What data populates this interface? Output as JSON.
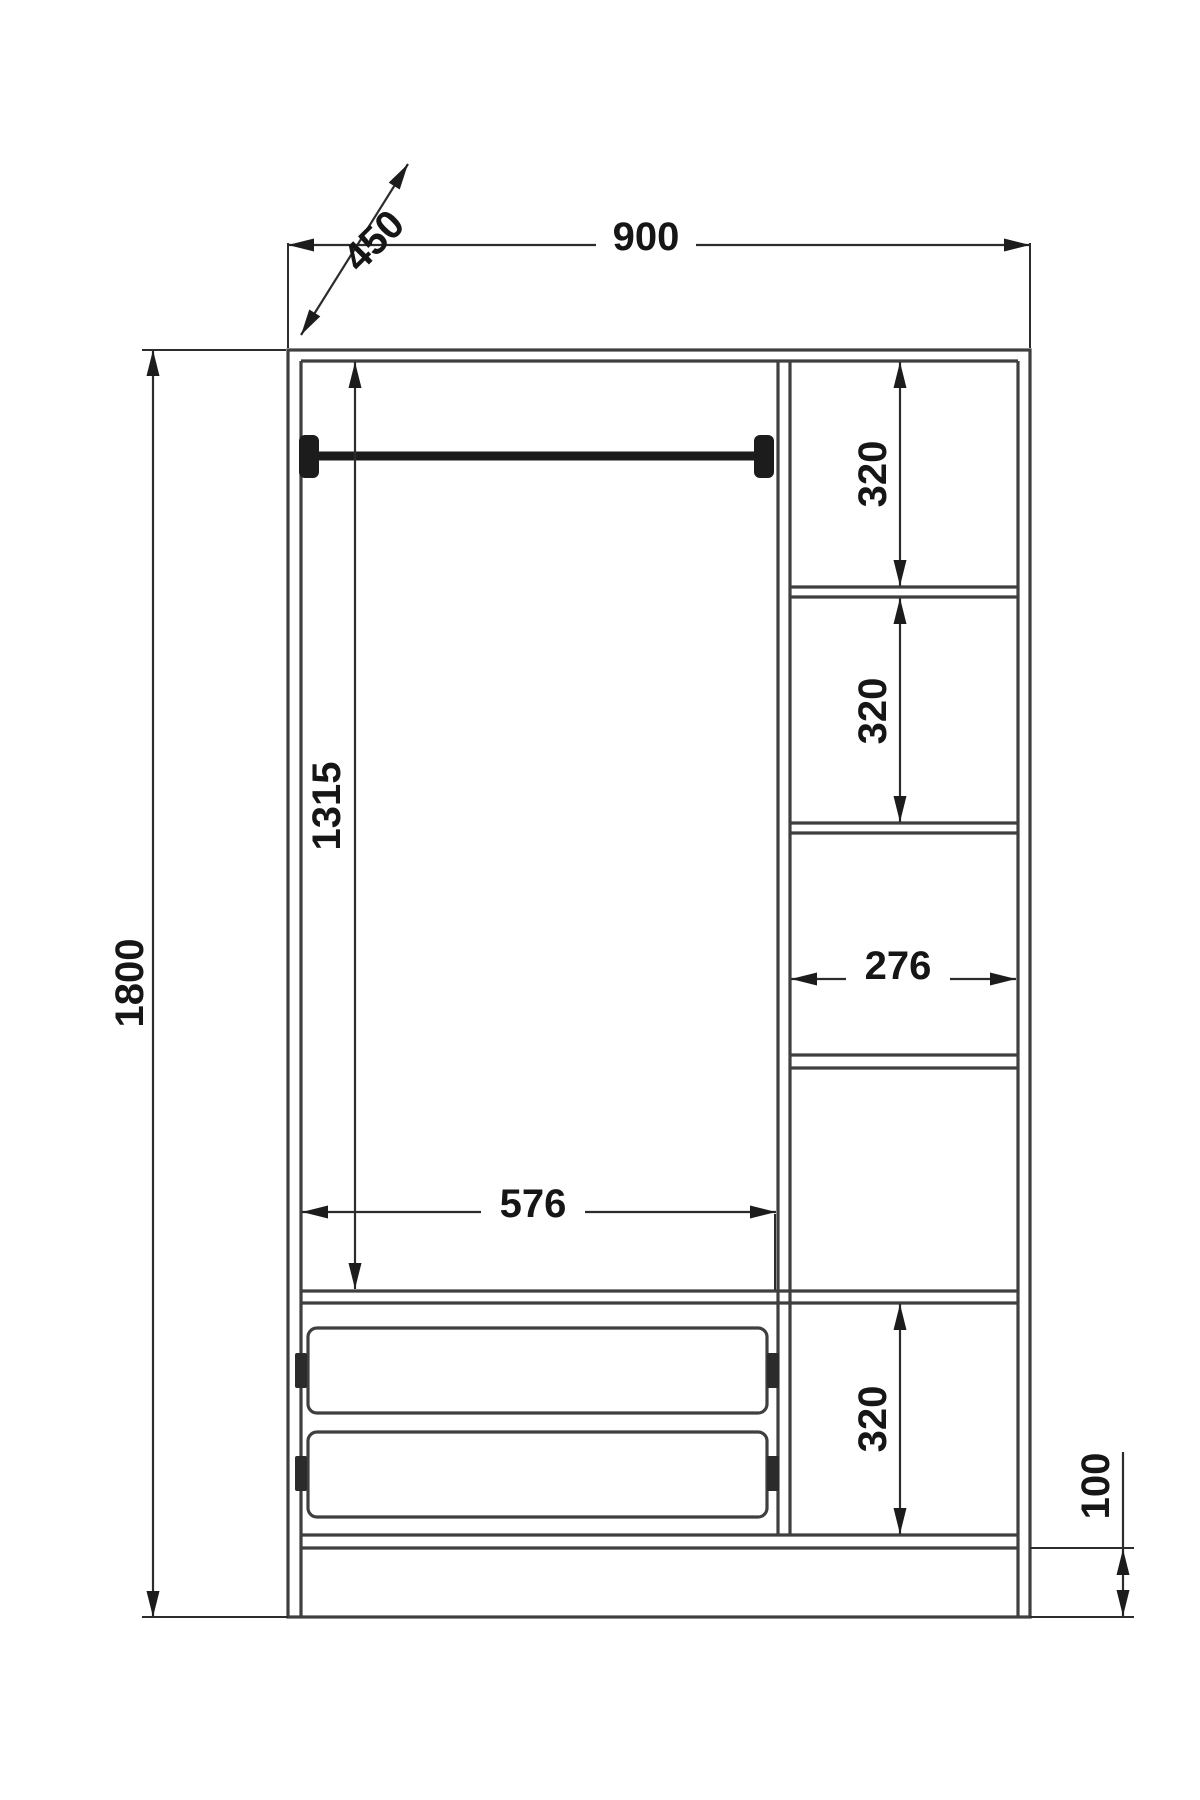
{
  "drawing": {
    "title": "Wardrobe dimensioned front elevation",
    "labels": {
      "overall_width": "900",
      "depth": "450",
      "overall_height": "1800",
      "interior_height": "1315",
      "interior_width": "576",
      "side_shelf_width": "276",
      "side_shelf_gap_top": "320",
      "side_shelf_gap_middle": "320",
      "side_shelf_gap_bottom": "320",
      "plinth_height": "100"
    },
    "colors": {
      "structure_line": "#3f3f3f",
      "dimension_line": "#2c2c2c",
      "rod_fill": "#1c1c1c",
      "text": "#161616",
      "background": "#ffffff"
    }
  }
}
